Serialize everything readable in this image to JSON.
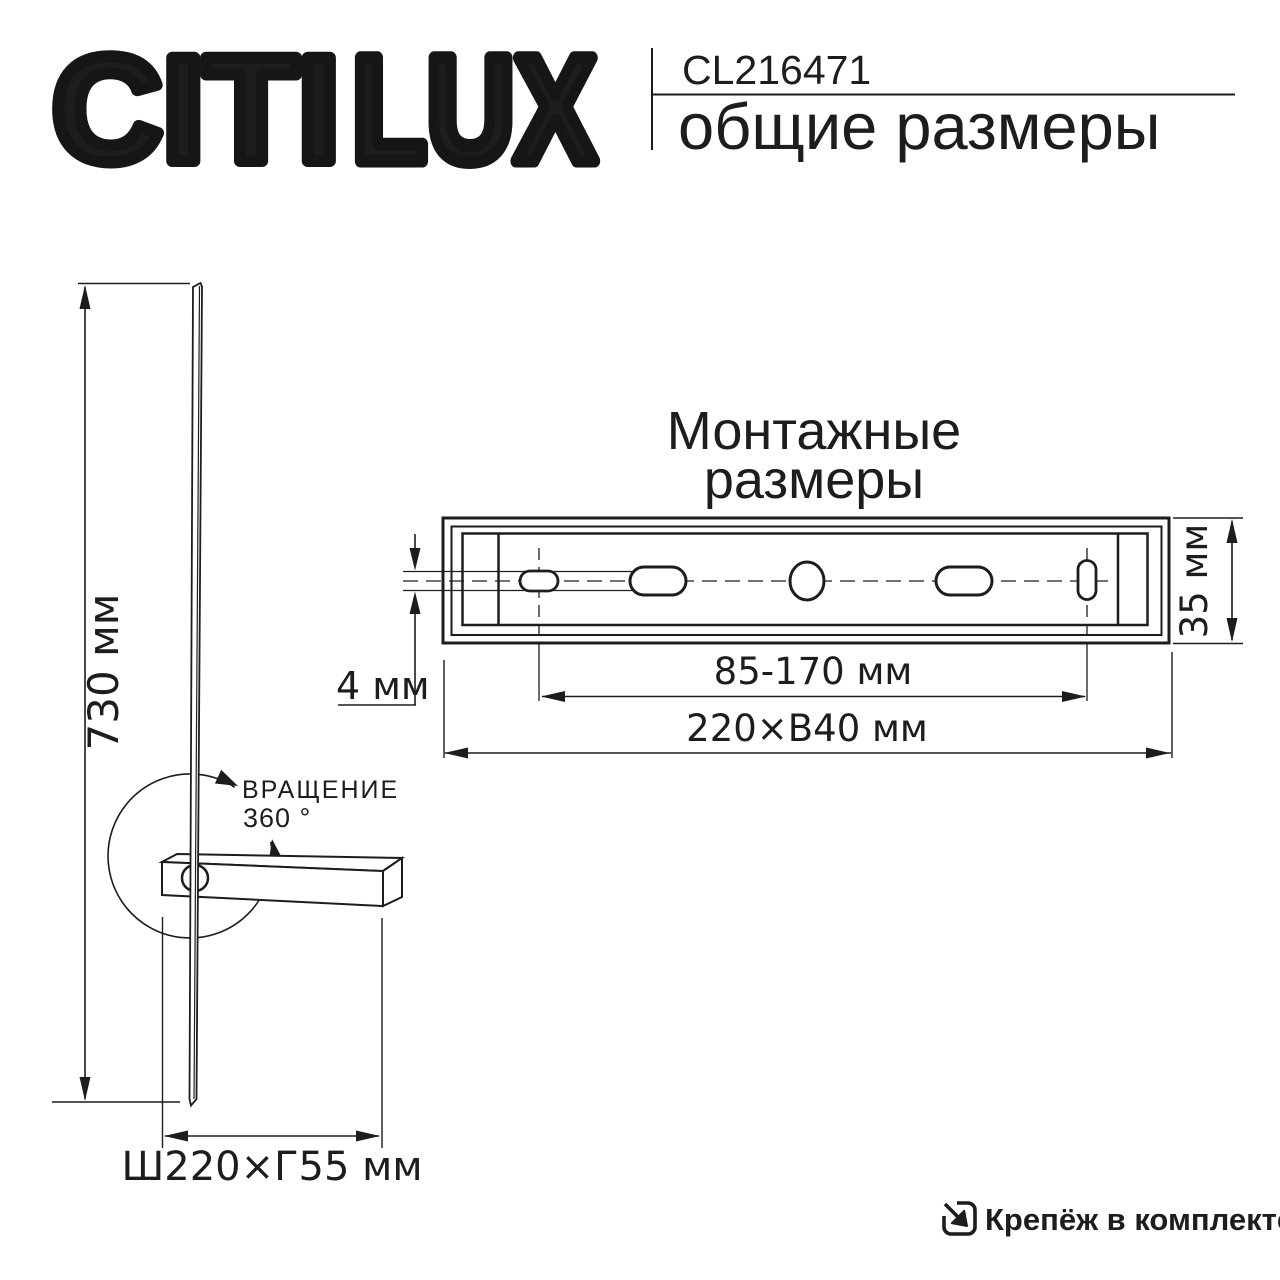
{
  "header": {
    "logo_solid": "CITI",
    "logo_outline": "LUX",
    "product_code": "CL216471",
    "subtitle": "общие размеры"
  },
  "side_view": {
    "height_label": "730 мм",
    "rotation_label_line1": "ВРАЩЕНИЕ",
    "rotation_label_line2": "360 °",
    "footprint_label": "Ш220×Г55 мм"
  },
  "mounting": {
    "title_line1": "Монтажные",
    "title_line2": "размеры",
    "slot_height_label": "4 мм",
    "hole_spacing_label": "85-170 мм",
    "plate_width_label": "220×В40 мм",
    "plate_height_label": "35 мм"
  },
  "footer": {
    "included_label": "Крепёж в комплекте"
  },
  "colors": {
    "ink": "#1d1d1d",
    "background": "#ffffff"
  }
}
